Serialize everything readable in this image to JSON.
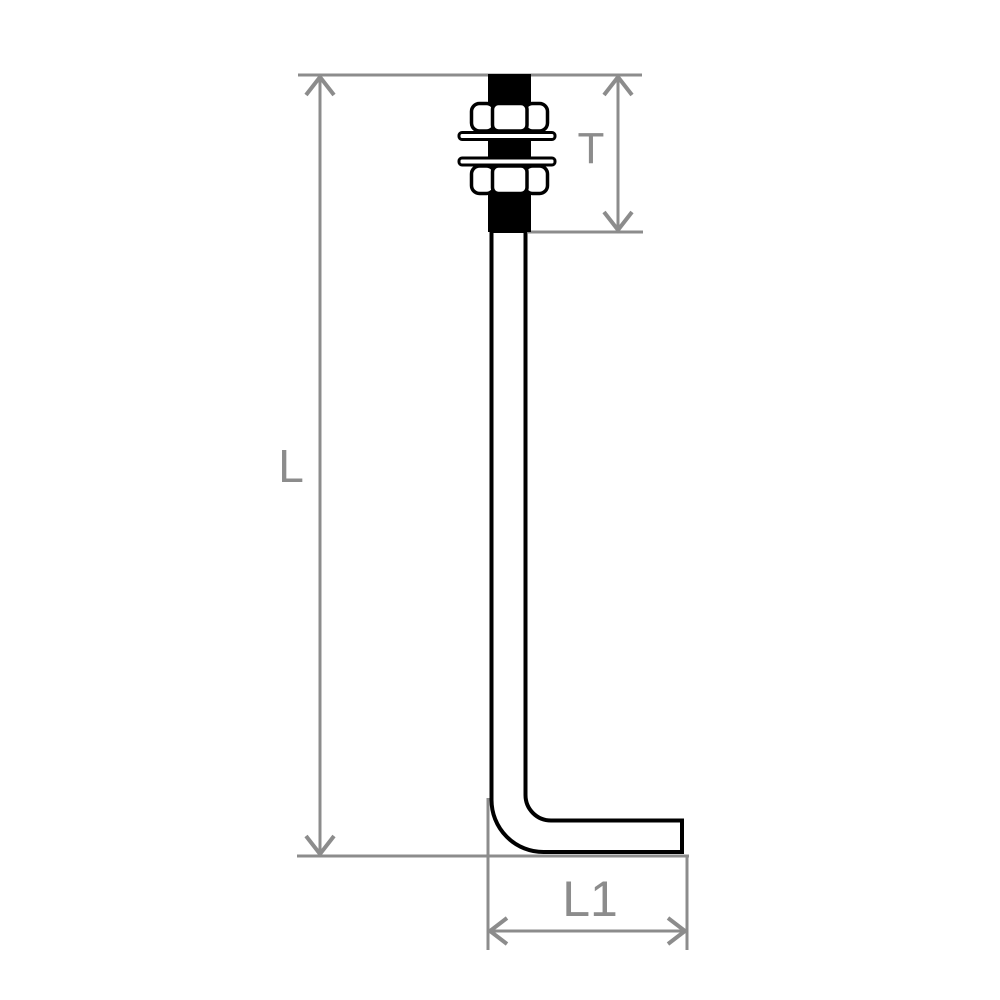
{
  "diagram": {
    "kind": "technical-dimension-drawing",
    "subject": "L-shaped anchor bolt with two hex nuts and two washers",
    "labels": {
      "total_length": "L",
      "thread_length": "T",
      "leg_length": "L1"
    },
    "colors": {
      "outline": "#000000",
      "dimension": "#8c8c8c",
      "fill": "#ffffff",
      "background": "#ffffff"
    }
  }
}
